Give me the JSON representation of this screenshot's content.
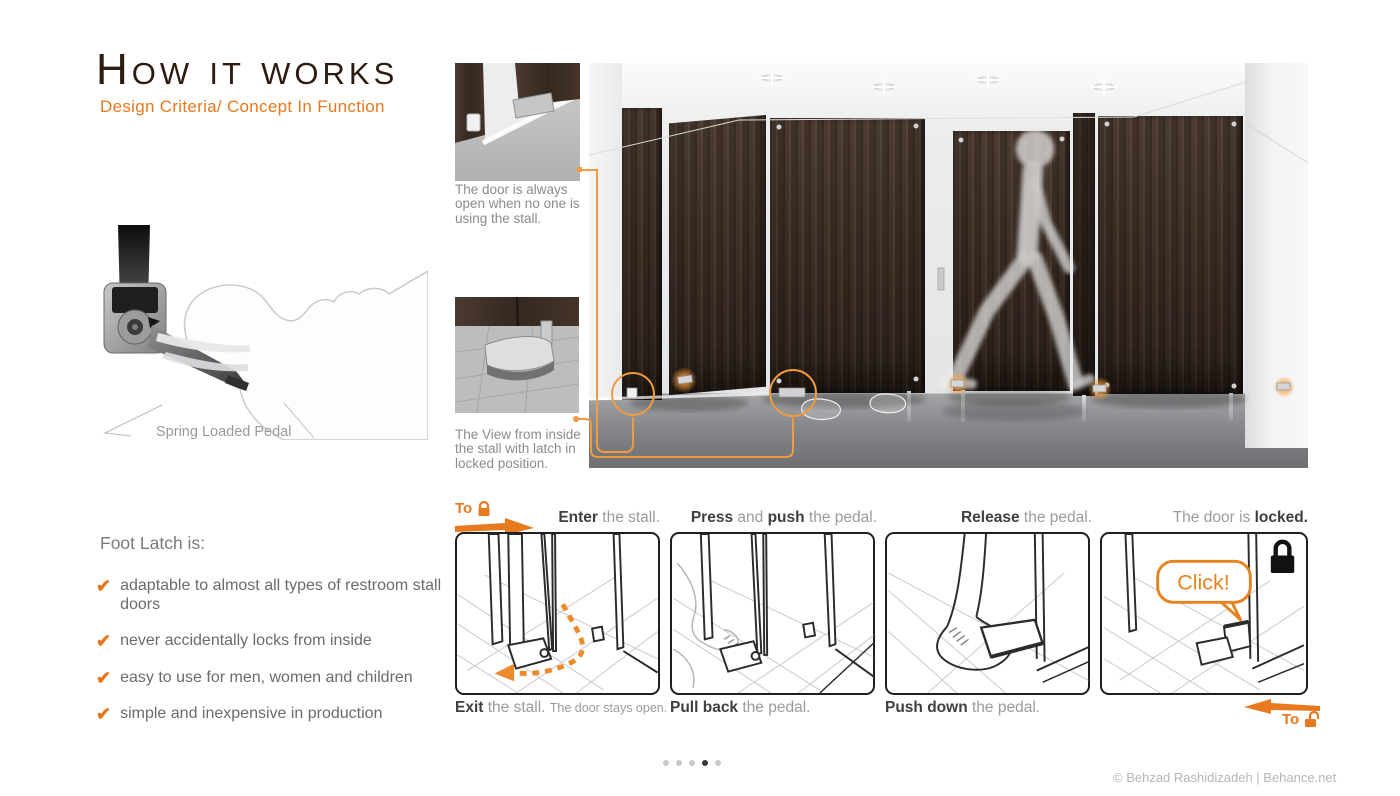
{
  "header": {
    "title": "How it works",
    "subtitle": "Design Criteria/ Concept In Function"
  },
  "pedal_figure": {
    "label": "Spring Loaded Pedal"
  },
  "features": {
    "heading": "Foot Latch is:",
    "check_glyph": "✔",
    "items": [
      "adaptable to almost all types of restroom stall doors",
      "never accidentally locks from inside",
      "easy to use for men, women and children",
      "simple and inexpensive in production"
    ]
  },
  "insets": {
    "one_caption": "The door is always open when no one is using the stall.",
    "two_caption": "The View from inside the stall with latch in locked position."
  },
  "sequence": {
    "to_lock_label": "To",
    "to_unlock_label": "To",
    "click_label": "Click!",
    "steps": [
      {
        "top": {
          "b1": "Enter",
          "r1": " the stall."
        },
        "bottom": {
          "b1": "Exit",
          "r1": " the stall. ",
          "note": "The door stays open."
        }
      },
      {
        "top": {
          "b1": "Press",
          "r1": " and ",
          "b2": "push",
          "r2": " the pedal."
        },
        "bottom": {
          "b1": "Pull back",
          "r1": " the pedal."
        }
      },
      {
        "top": {
          "b1": "Release",
          "r1": " the pedal."
        },
        "bottom": {
          "b1": "Push down",
          "r1": " the pedal."
        }
      },
      {
        "top": {
          "r0": "The door is ",
          "b1": "locked."
        },
        "bottom": {}
      }
    ]
  },
  "pagination": {
    "count": 5,
    "active_index": 3
  },
  "footer": {
    "credit": "© Behzad Rashidizadeh | Behance.net"
  },
  "colors": {
    "accent": "#E8791E",
    "accent_light": "#F09A42",
    "title_brown": "#2E1B10",
    "caption_gray": "#8B8B8B",
    "text_gray": "#6B6B6B",
    "wood_dark": "#3B2D24"
  }
}
